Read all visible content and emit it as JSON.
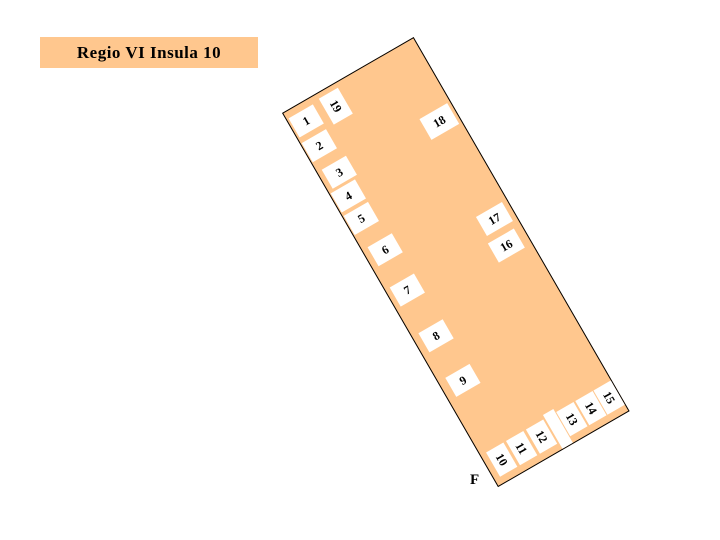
{
  "title": {
    "text": "Regio VI Insula 10"
  },
  "map": {
    "street_label": "F",
    "entrances": [
      {
        "number": "1",
        "x": 2,
        "y": 7,
        "w": 28,
        "h": 22,
        "rot": 0
      },
      {
        "number": "2",
        "x": 1,
        "y": 35,
        "w": 28,
        "h": 22,
        "rot": 0
      },
      {
        "number": "3",
        "x": 5,
        "y": 68,
        "w": 28,
        "h": 22,
        "rot": 0
      },
      {
        "number": "4",
        "x": 1,
        "y": 93,
        "w": 28,
        "h": 22,
        "rot": 0
      },
      {
        "number": "5",
        "x": 1,
        "y": 119,
        "w": 28,
        "h": 22,
        "rot": 0
      },
      {
        "number": "6",
        "x": 6,
        "y": 158,
        "w": 28,
        "h": 22,
        "rot": 0
      },
      {
        "number": "7",
        "x": 5,
        "y": 204,
        "w": 28,
        "h": 22,
        "rot": 0
      },
      {
        "number": "8",
        "x": 7,
        "y": 258,
        "w": 28,
        "h": 22,
        "rot": 0
      },
      {
        "number": "9",
        "x": 8,
        "y": 310,
        "w": 28,
        "h": 22,
        "rot": 0
      },
      {
        "number": "10",
        "x": 6,
        "y": 395,
        "w": 20,
        "h": 28,
        "rot": 90
      },
      {
        "number": "11",
        "x": 29,
        "y": 395,
        "w": 20,
        "h": 28,
        "rot": 90
      },
      {
        "number": "12",
        "x": 52,
        "y": 395,
        "w": 20,
        "h": 28,
        "rot": 90
      },
      {
        "number": "13",
        "x": 87,
        "y": 395,
        "w": 20,
        "h": 28,
        "rot": 90
      },
      {
        "number": "14",
        "x": 109,
        "y": 395,
        "w": 20,
        "h": 28,
        "rot": 90
      },
      {
        "number": "15",
        "x": 130,
        "y": 395,
        "w": 20,
        "h": 28,
        "rot": 90
      },
      {
        "number": "16",
        "x": 112,
        "y": 215,
        "w": 30,
        "h": 22,
        "rot": 0
      },
      {
        "number": "17",
        "x": 115,
        "y": 186,
        "w": 30,
        "h": 22,
        "rot": 0
      },
      {
        "number": "18",
        "x": 115,
        "y": 73,
        "w": 32,
        "h": 24,
        "rot": 0
      },
      {
        "number": "19",
        "x": 38,
        "y": 5,
        "w": 22,
        "h": 30,
        "rot": 90
      }
    ],
    "passage": {
      "x": 74,
      "y": 391,
      "w": 12,
      "h": 39
    }
  },
  "colors": {
    "block_fill": "#FFC78E",
    "outline": "#000000",
    "entrance_fill": "#FFFFFF",
    "text": "#000000"
  }
}
